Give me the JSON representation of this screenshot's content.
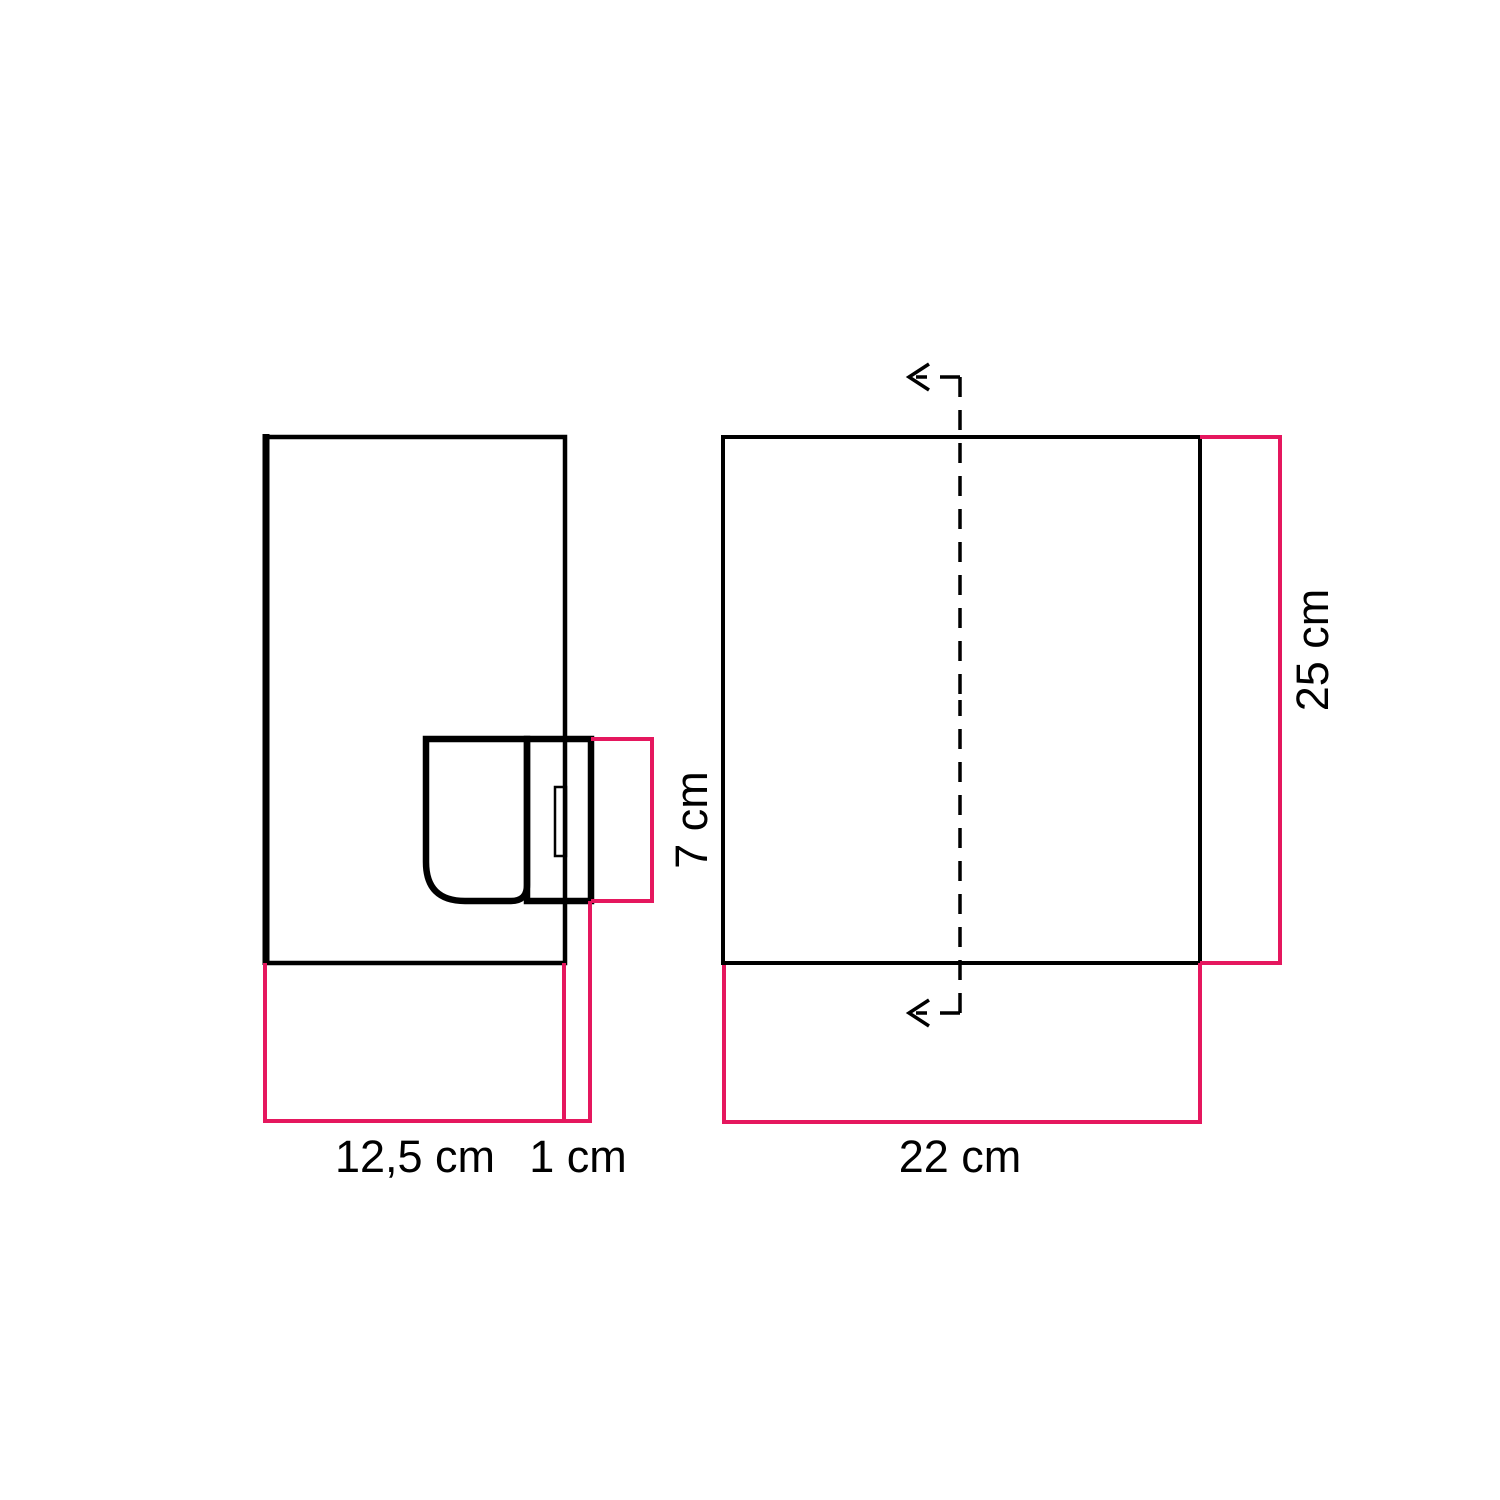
{
  "colors": {
    "outline": "#000000",
    "dimension": "#e5175e"
  },
  "side_view": {
    "width_label": "12,5 cm",
    "protrusion_label": "1 cm",
    "socket_height_label": "7 cm"
  },
  "front_view": {
    "width_label": "22 cm",
    "height_label": "25 cm"
  }
}
